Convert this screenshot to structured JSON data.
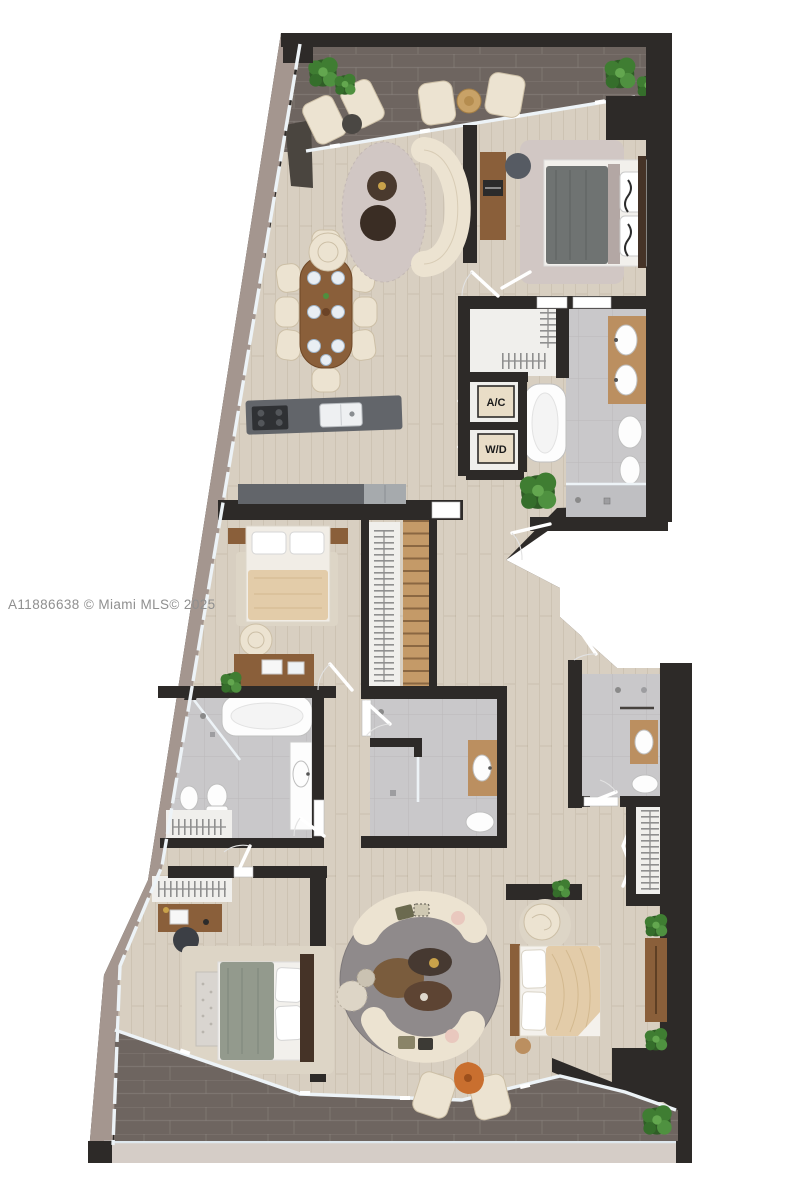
{
  "meta": {
    "watermark": "A11886638 © Miami MLS© 2025"
  },
  "labels": {
    "ac": "A/C",
    "wd": "W/D"
  },
  "colors": {
    "wall": "#2d2a28",
    "wood": "#d8cfc1",
    "bathTile": "#c9c8ca",
    "terraceTile": "#6e6560",
    "facade": "#a4968f",
    "bottomBand": "#d5cdc7",
    "closet": "#f0efec",
    "glass": "#edf3f7",
    "cream": "#ece3d1",
    "creamEdge": "#ccbfa6",
    "woodFurniture": "#8a5f3a",
    "woodLight": "#bb8f60",
    "woodDark": "#453327",
    "grayBlanket": "#6f7372",
    "beigeBlanket": "#e3cca9",
    "sageBlanket": "#939a8d",
    "rugGray": "#8f8a8b",
    "rugBeige": "#ddd5c6",
    "rugFuzzy": "#d1c7c4",
    "plant": "#3f7d32",
    "plantDark": "#2f5d26",
    "steel": "#a6aaad",
    "counter": "#62656a",
    "accentOrange": "#c96f2f",
    "labelBg": "#e9ddc7",
    "ink": "#1c1c1c",
    "watermark": "#8f8f8f",
    "white": "#ffffff"
  }
}
